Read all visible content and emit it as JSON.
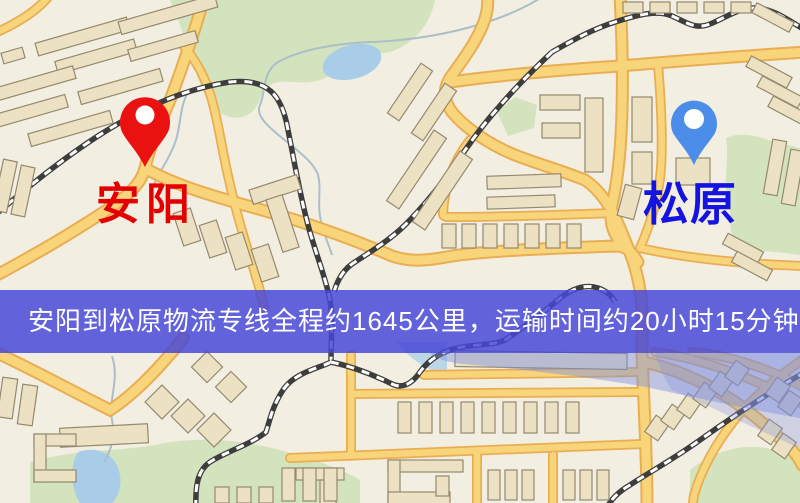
{
  "banner": {
    "text": "安阳到松原物流专线全程约1645公里，运输时间约20小时15分钟.",
    "background": "#4646d8",
    "text_color": "#ffffff"
  },
  "markers": {
    "origin": {
      "label": "安阳",
      "icon": "map-pin",
      "pin_color": "#ea1111",
      "hole_color": "#ffffff",
      "label_color": "#e50000"
    },
    "destination": {
      "label": "松原",
      "icon": "map-pin",
      "pin_color": "#4b8de8",
      "hole_color": "#ffffff",
      "label_color": "#1414e0"
    }
  },
  "map": {
    "palette": {
      "background": "#f3eee2",
      "road_fill": "#f8d47a",
      "road_casing": "#e9ae53",
      "building_fill": "#ece1c3",
      "building_stroke": "#95896f",
      "green": "#d3e3bd",
      "water": "#a9cce8",
      "stream": "#aabfc8",
      "railway": "#3d3d3d",
      "haze": "#7d8fe0"
    }
  }
}
